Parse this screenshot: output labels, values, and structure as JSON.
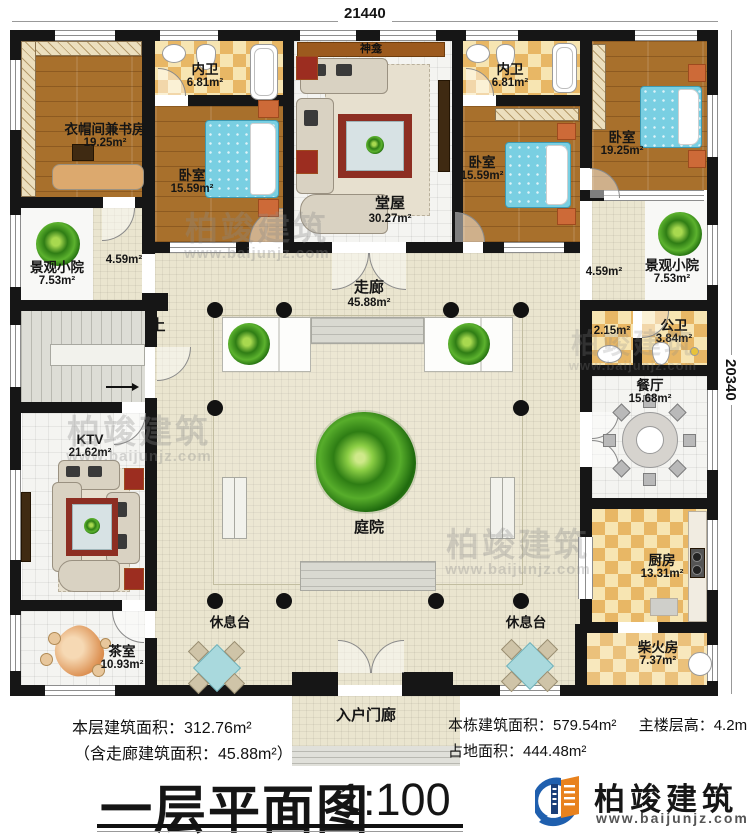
{
  "dims": {
    "top": "21440",
    "right": "20340"
  },
  "rooms": {
    "cloak_study": {
      "name": "衣帽间兼书房",
      "area": "19.25m²"
    },
    "bath_left": {
      "name": "内卫",
      "area": "6.81m²"
    },
    "bedroom_left": {
      "name": "卧室",
      "area": "15.59m²"
    },
    "shrine": {
      "name": "神龛"
    },
    "hall": {
      "name": "堂屋",
      "area": "30.27m²"
    },
    "bath_right": {
      "name": "内卫",
      "area": "6.81m²"
    },
    "bedroom_mid": {
      "name": "卧室",
      "area": "15.59m²"
    },
    "bedroom_right": {
      "name": "卧室",
      "area": "19.25m²"
    },
    "yard_left": {
      "name": "景观小院",
      "area": "7.53m²"
    },
    "yard_right": {
      "name": "景观小院",
      "area": "7.53m²"
    },
    "lobby_left": {
      "area": "4.59m²"
    },
    "lobby_right": {
      "area": "4.59m²"
    },
    "corridor": {
      "name": "走廊",
      "area": "45.88m²"
    },
    "stair": {
      "up": "上"
    },
    "wash": {
      "area": "2.15m²"
    },
    "public_bath": {
      "name": "公卫",
      "area": "3.84m²"
    },
    "dining": {
      "name": "餐厅",
      "area": "15.68m²"
    },
    "ktv": {
      "name": "KTV",
      "area": "21.62m²"
    },
    "courtyard": {
      "name": "庭院"
    },
    "kitchen": {
      "name": "厨房",
      "area": "13.31m²"
    },
    "tea": {
      "name": "茶室",
      "area": "10.93m²"
    },
    "rest_left": {
      "name": "休息台"
    },
    "rest_right": {
      "name": "休息台"
    },
    "firewood": {
      "name": "柴火房",
      "area": "7.37m²"
    },
    "porch": {
      "name": "入户门廊"
    }
  },
  "stats": {
    "floor_area": "本层建筑面积：312.76m²",
    "corridor_note": "（含走廊建筑面积：45.88m²）",
    "building_area": "本栋建筑面积：579.54m²",
    "floor_height": "主楼层高：4.2m",
    "land_area": "占地面积：444.48m²"
  },
  "title": {
    "main": "一层平面图",
    "scale": "1:100"
  },
  "logo": {
    "brand": "柏竣建筑",
    "url": "www.baijunjz.com"
  },
  "watermark": {
    "brand": "柏竣建筑",
    "url": "www.baijunjz.com"
  }
}
